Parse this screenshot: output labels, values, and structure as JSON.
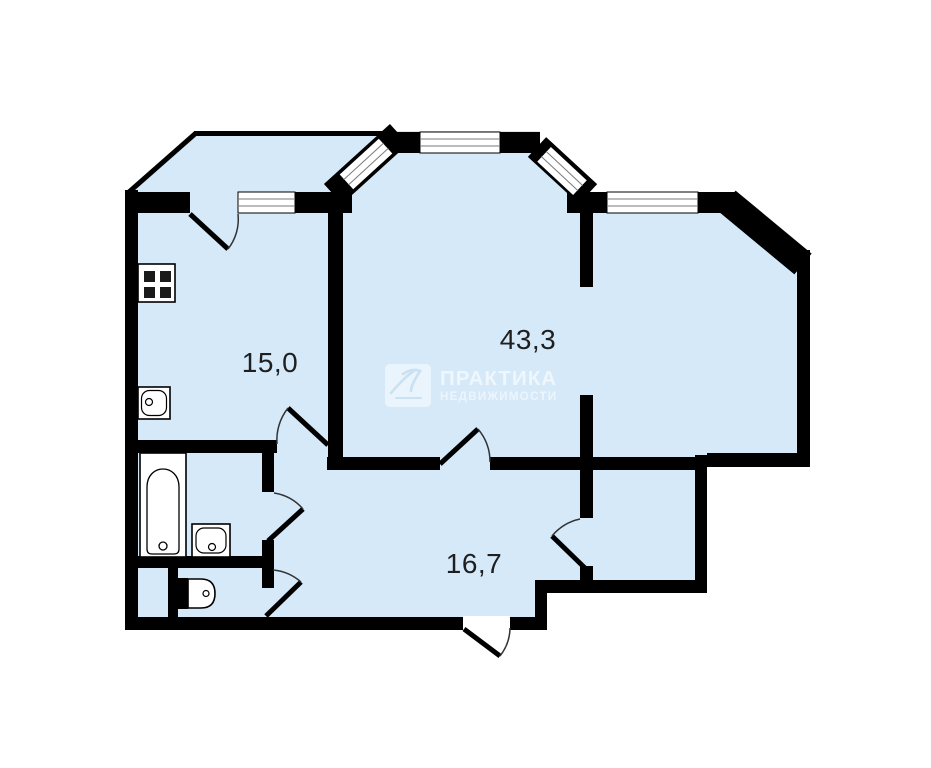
{
  "document": {
    "type": "apartment-floor-plan",
    "background": "#ffffff"
  },
  "rooms": [
    {
      "id": "kitchen",
      "area_label": "15,0"
    },
    {
      "id": "living-room",
      "area_label": "43,3"
    },
    {
      "id": "hallway",
      "area_label": "16,7"
    }
  ],
  "watermark": {
    "title": "ПРАКТИКА",
    "subtitle": "НЕДВИЖИМОСТИ",
    "logo": "praktika-signature-logo"
  },
  "fixtures": [
    "stove",
    "kitchen-sink",
    "bathtub",
    "bathroom-sink",
    "toilet"
  ],
  "features": [
    "balcony",
    "bay-window",
    "entrance-door",
    "storage-room"
  ],
  "colors": {
    "floor_fill": "#d5e9f9",
    "wall": "#000000",
    "window_fill": "#ffffff",
    "window_mullion": "#7a7a7a",
    "watermark": "rgba(255,255,255,0.6)"
  }
}
